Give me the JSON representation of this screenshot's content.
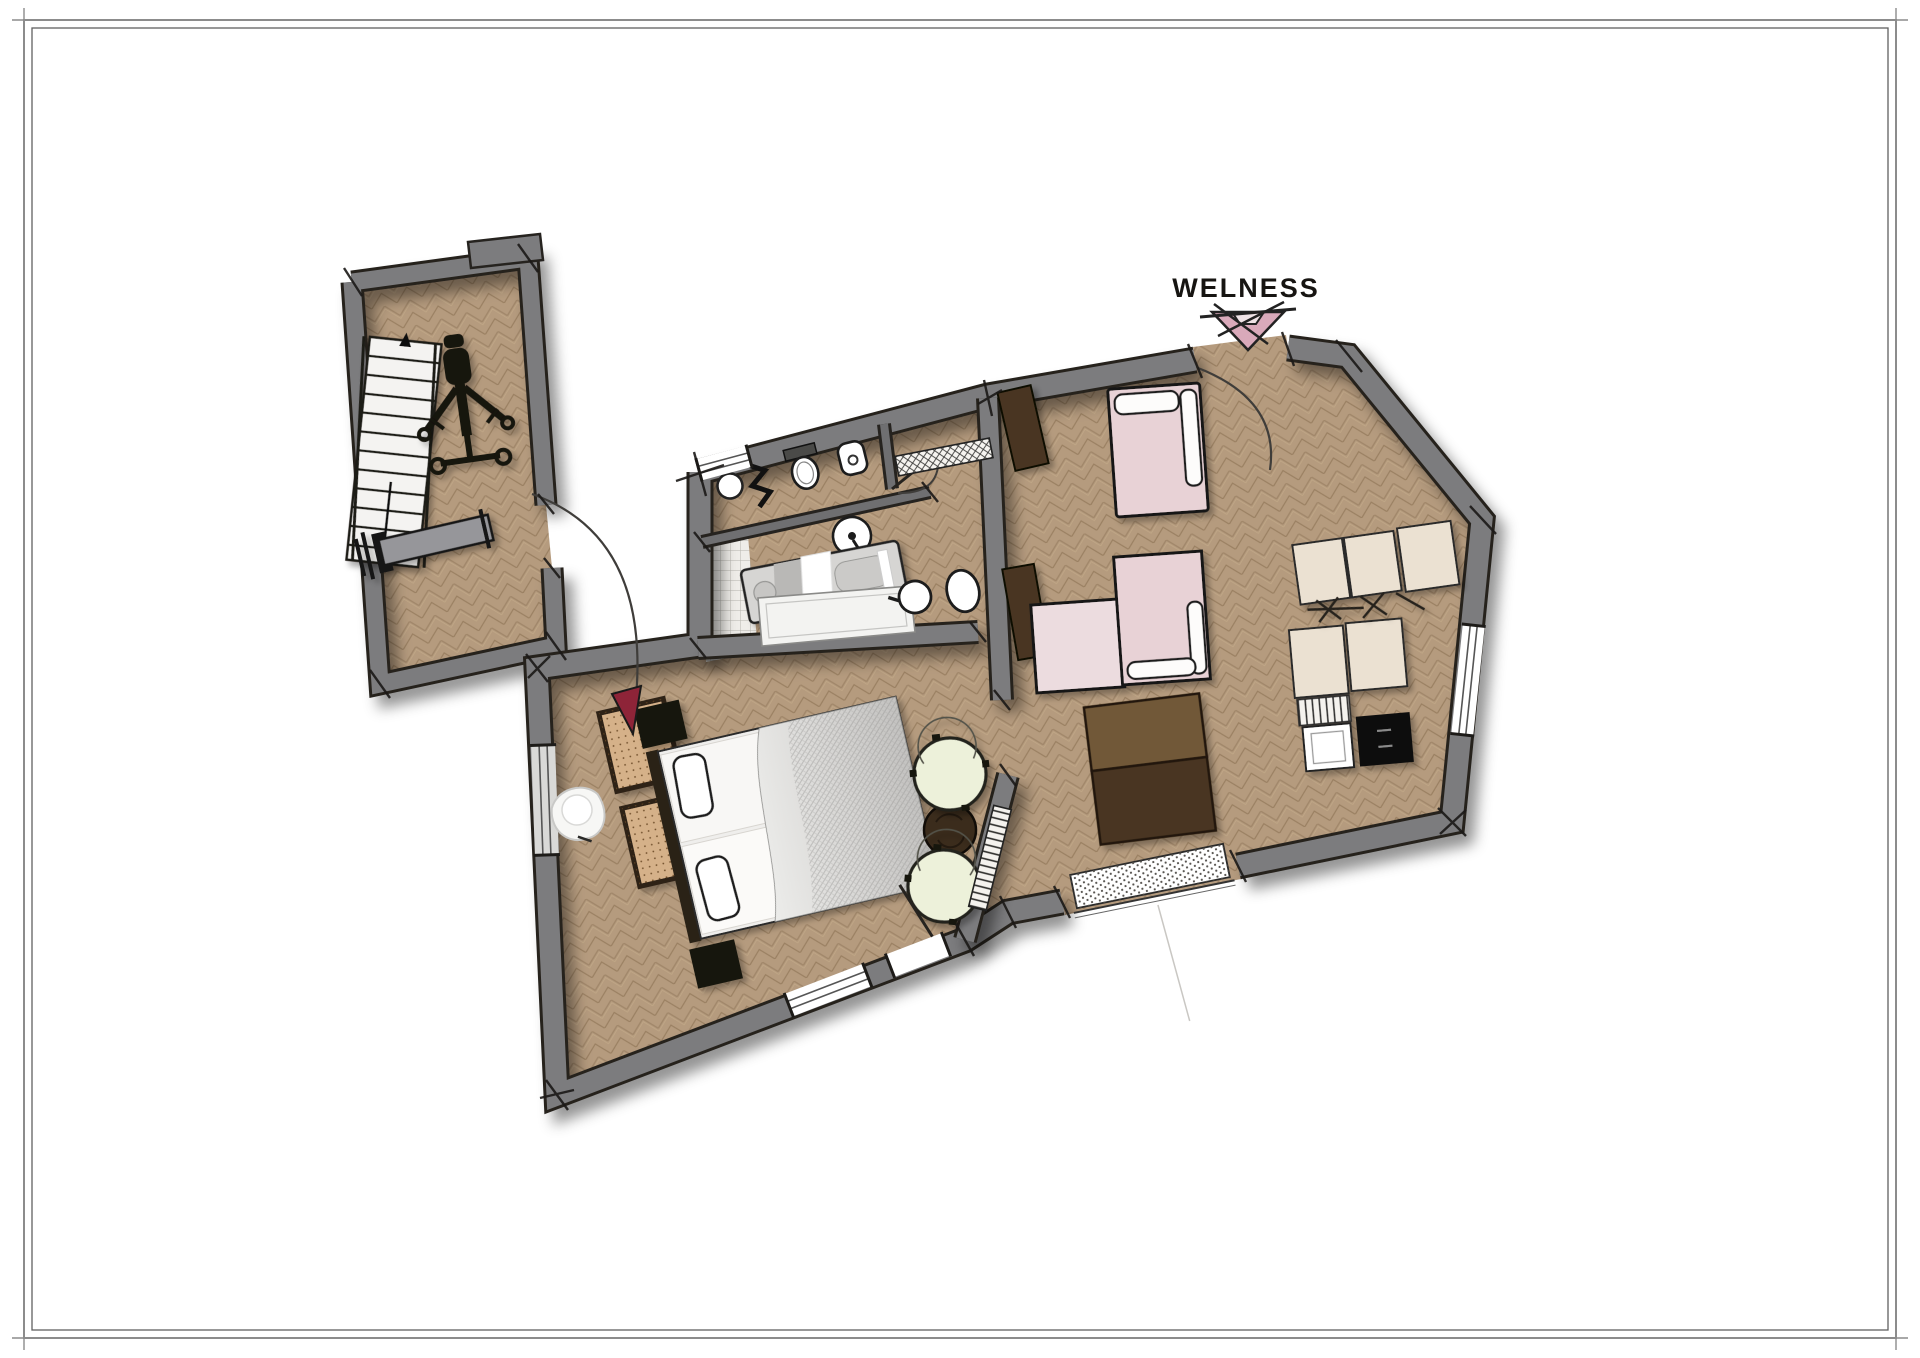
{
  "page": {
    "background": "#ffffff"
  },
  "frame": {
    "outer_color": "#8c8c8c",
    "inner_color": "#606060"
  },
  "plan": {
    "labels": {
      "welness": "WELNESS"
    },
    "colors": {
      "wall": "#7c7c7e",
      "wall_edge": "#26231f",
      "floor": "#b59b7e",
      "floor_line": "#a1876a",
      "tile_bg": "#efede9",
      "pink": "#e8d2d6",
      "pink_light": "#ecdcdf",
      "pink_arrow": "#d9a9ba",
      "cream": "#ebe1d2",
      "green": "#edf1da",
      "tan": "#d5b189",
      "brown_dark": "#4a3622",
      "brown_mid": "#715939",
      "table_round": "#3b2c1c",
      "red_door": "#8e2438",
      "black": "#171512",
      "white": "#ffffff",
      "bench_gray": "#96969a",
      "mattress": "#f8f7f5",
      "duvet": "#d4d3d1",
      "massage_table": "#d6d5d3"
    },
    "furniture": [
      {
        "name": "staircase"
      },
      {
        "name": "gym-machine"
      },
      {
        "name": "weight-bench"
      },
      {
        "name": "corner-sink"
      },
      {
        "name": "towel-radiator"
      },
      {
        "name": "toilet"
      },
      {
        "name": "bidet"
      },
      {
        "name": "pedestal-basin"
      },
      {
        "name": "washbasin-round"
      },
      {
        "name": "washbasin-oval"
      },
      {
        "name": "massage-table"
      },
      {
        "name": "bathtub"
      },
      {
        "name": "shower-tiles"
      },
      {
        "name": "double-bed"
      },
      {
        "name": "bedside-table"
      },
      {
        "name": "luggage-bench"
      },
      {
        "name": "armchair"
      },
      {
        "name": "side-table"
      },
      {
        "name": "lounge-chair-white"
      },
      {
        "name": "daybed"
      },
      {
        "name": "corner-sofa"
      },
      {
        "name": "wardrobe-cabinet"
      },
      {
        "name": "desk"
      },
      {
        "name": "kitchenette"
      },
      {
        "name": "wardrobe-row"
      },
      {
        "name": "radiator"
      },
      {
        "name": "doormat"
      },
      {
        "name": "entrance-door"
      }
    ]
  }
}
